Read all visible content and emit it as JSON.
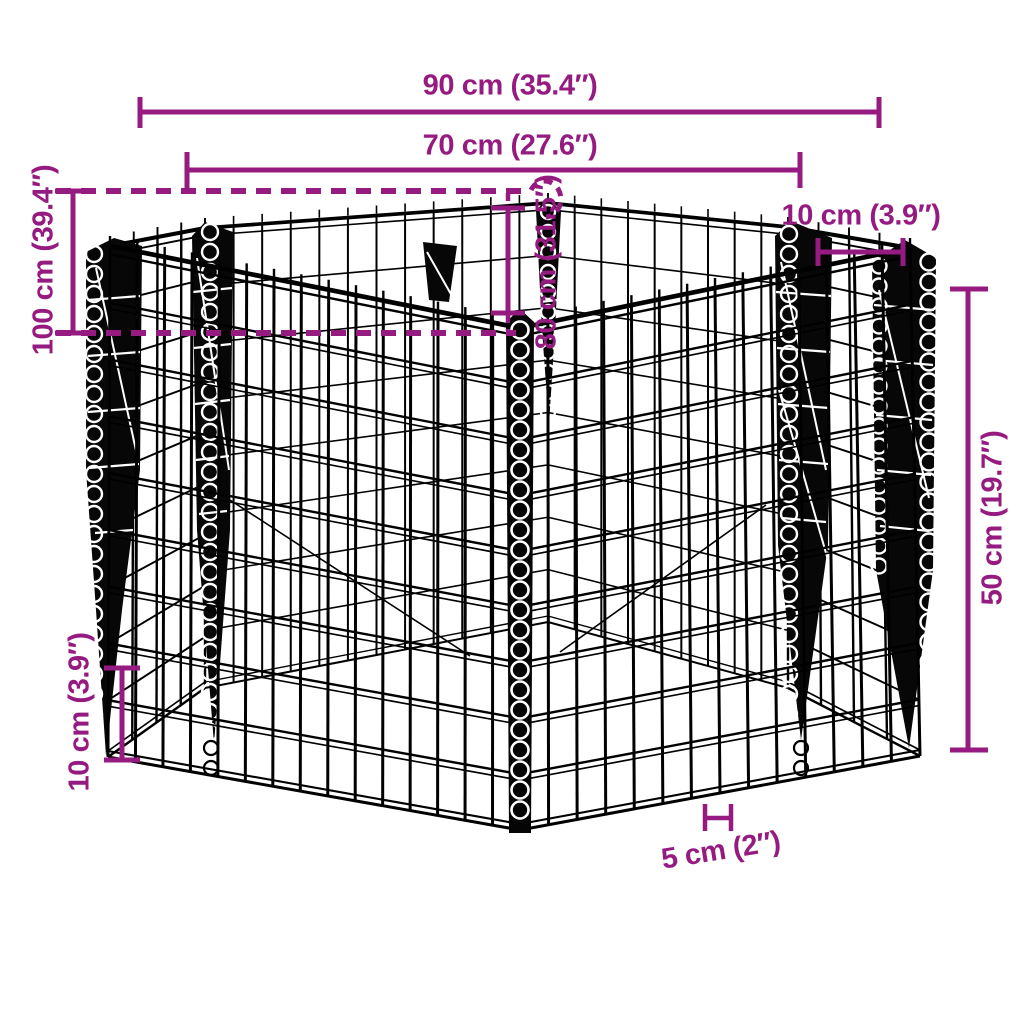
{
  "colors": {
    "accent": "#951b81",
    "structure": "#000000",
    "background": "#ffffff"
  },
  "dimensions": {
    "outer_width": {
      "label": "90 cm (35.4″)"
    },
    "inner_width": {
      "label": "70 cm (27.6″)"
    },
    "total_depth": {
      "label": "100 cm (39.4″)"
    },
    "inner_depth": {
      "label": "80 cm (31.5″)"
    },
    "corner_gap": {
      "label": "10 cm (3.9″)"
    },
    "side_height": {
      "label": "50 cm (19.7″)"
    },
    "ground_clearance": {
      "label": "10 cm (3.9″)"
    },
    "mesh_cell": {
      "label": "5 cm (2″)"
    }
  }
}
